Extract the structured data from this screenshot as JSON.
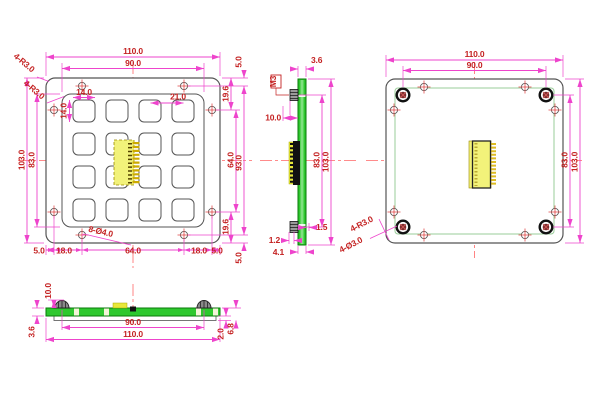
{
  "front": {
    "d110": "110.0",
    "d90": "90.0",
    "corner1": "4-R3.0",
    "corner2": "4-R3.0",
    "key_w": "14.0",
    "key_h": "14.0",
    "pitch": "21.0",
    "d103": "103.0",
    "d83": "83.0",
    "r5t": "5.0",
    "r196t": "19.6",
    "r64": "64.0",
    "r93": "93.0",
    "r196b": "19.6",
    "r5b": "5.0",
    "bottom_chain": [
      "5.0",
      "18.0",
      "64.0",
      "18.0",
      "5.0"
    ],
    "holes_label": "8-Ø4.0"
  },
  "side": {
    "d36": "3.6",
    "m3": "M3",
    "d10": "10.0",
    "d83": "83.0",
    "d103": "103.0",
    "d15": "1.5",
    "d12": "1.2",
    "d41": "4.1"
  },
  "back": {
    "d110": "110.0",
    "d90": "90.0",
    "d83": "83.0",
    "d103": "103.0",
    "label_radius": "4-R3.0",
    "label_holes": "4-Ø3.0"
  },
  "bottom_view": {
    "d10": "10.0",
    "d36": "3.6",
    "d90": "90.0",
    "d110": "110.0",
    "d20": "2.0",
    "d68": "6.8"
  },
  "colors": {
    "dimension_line": "#ee44cc",
    "text": "#c42222",
    "centerline": "#ff6666",
    "pcb_green": "#2ec82e",
    "connector_yellow": "#f2f27a",
    "outline": "#555555"
  }
}
